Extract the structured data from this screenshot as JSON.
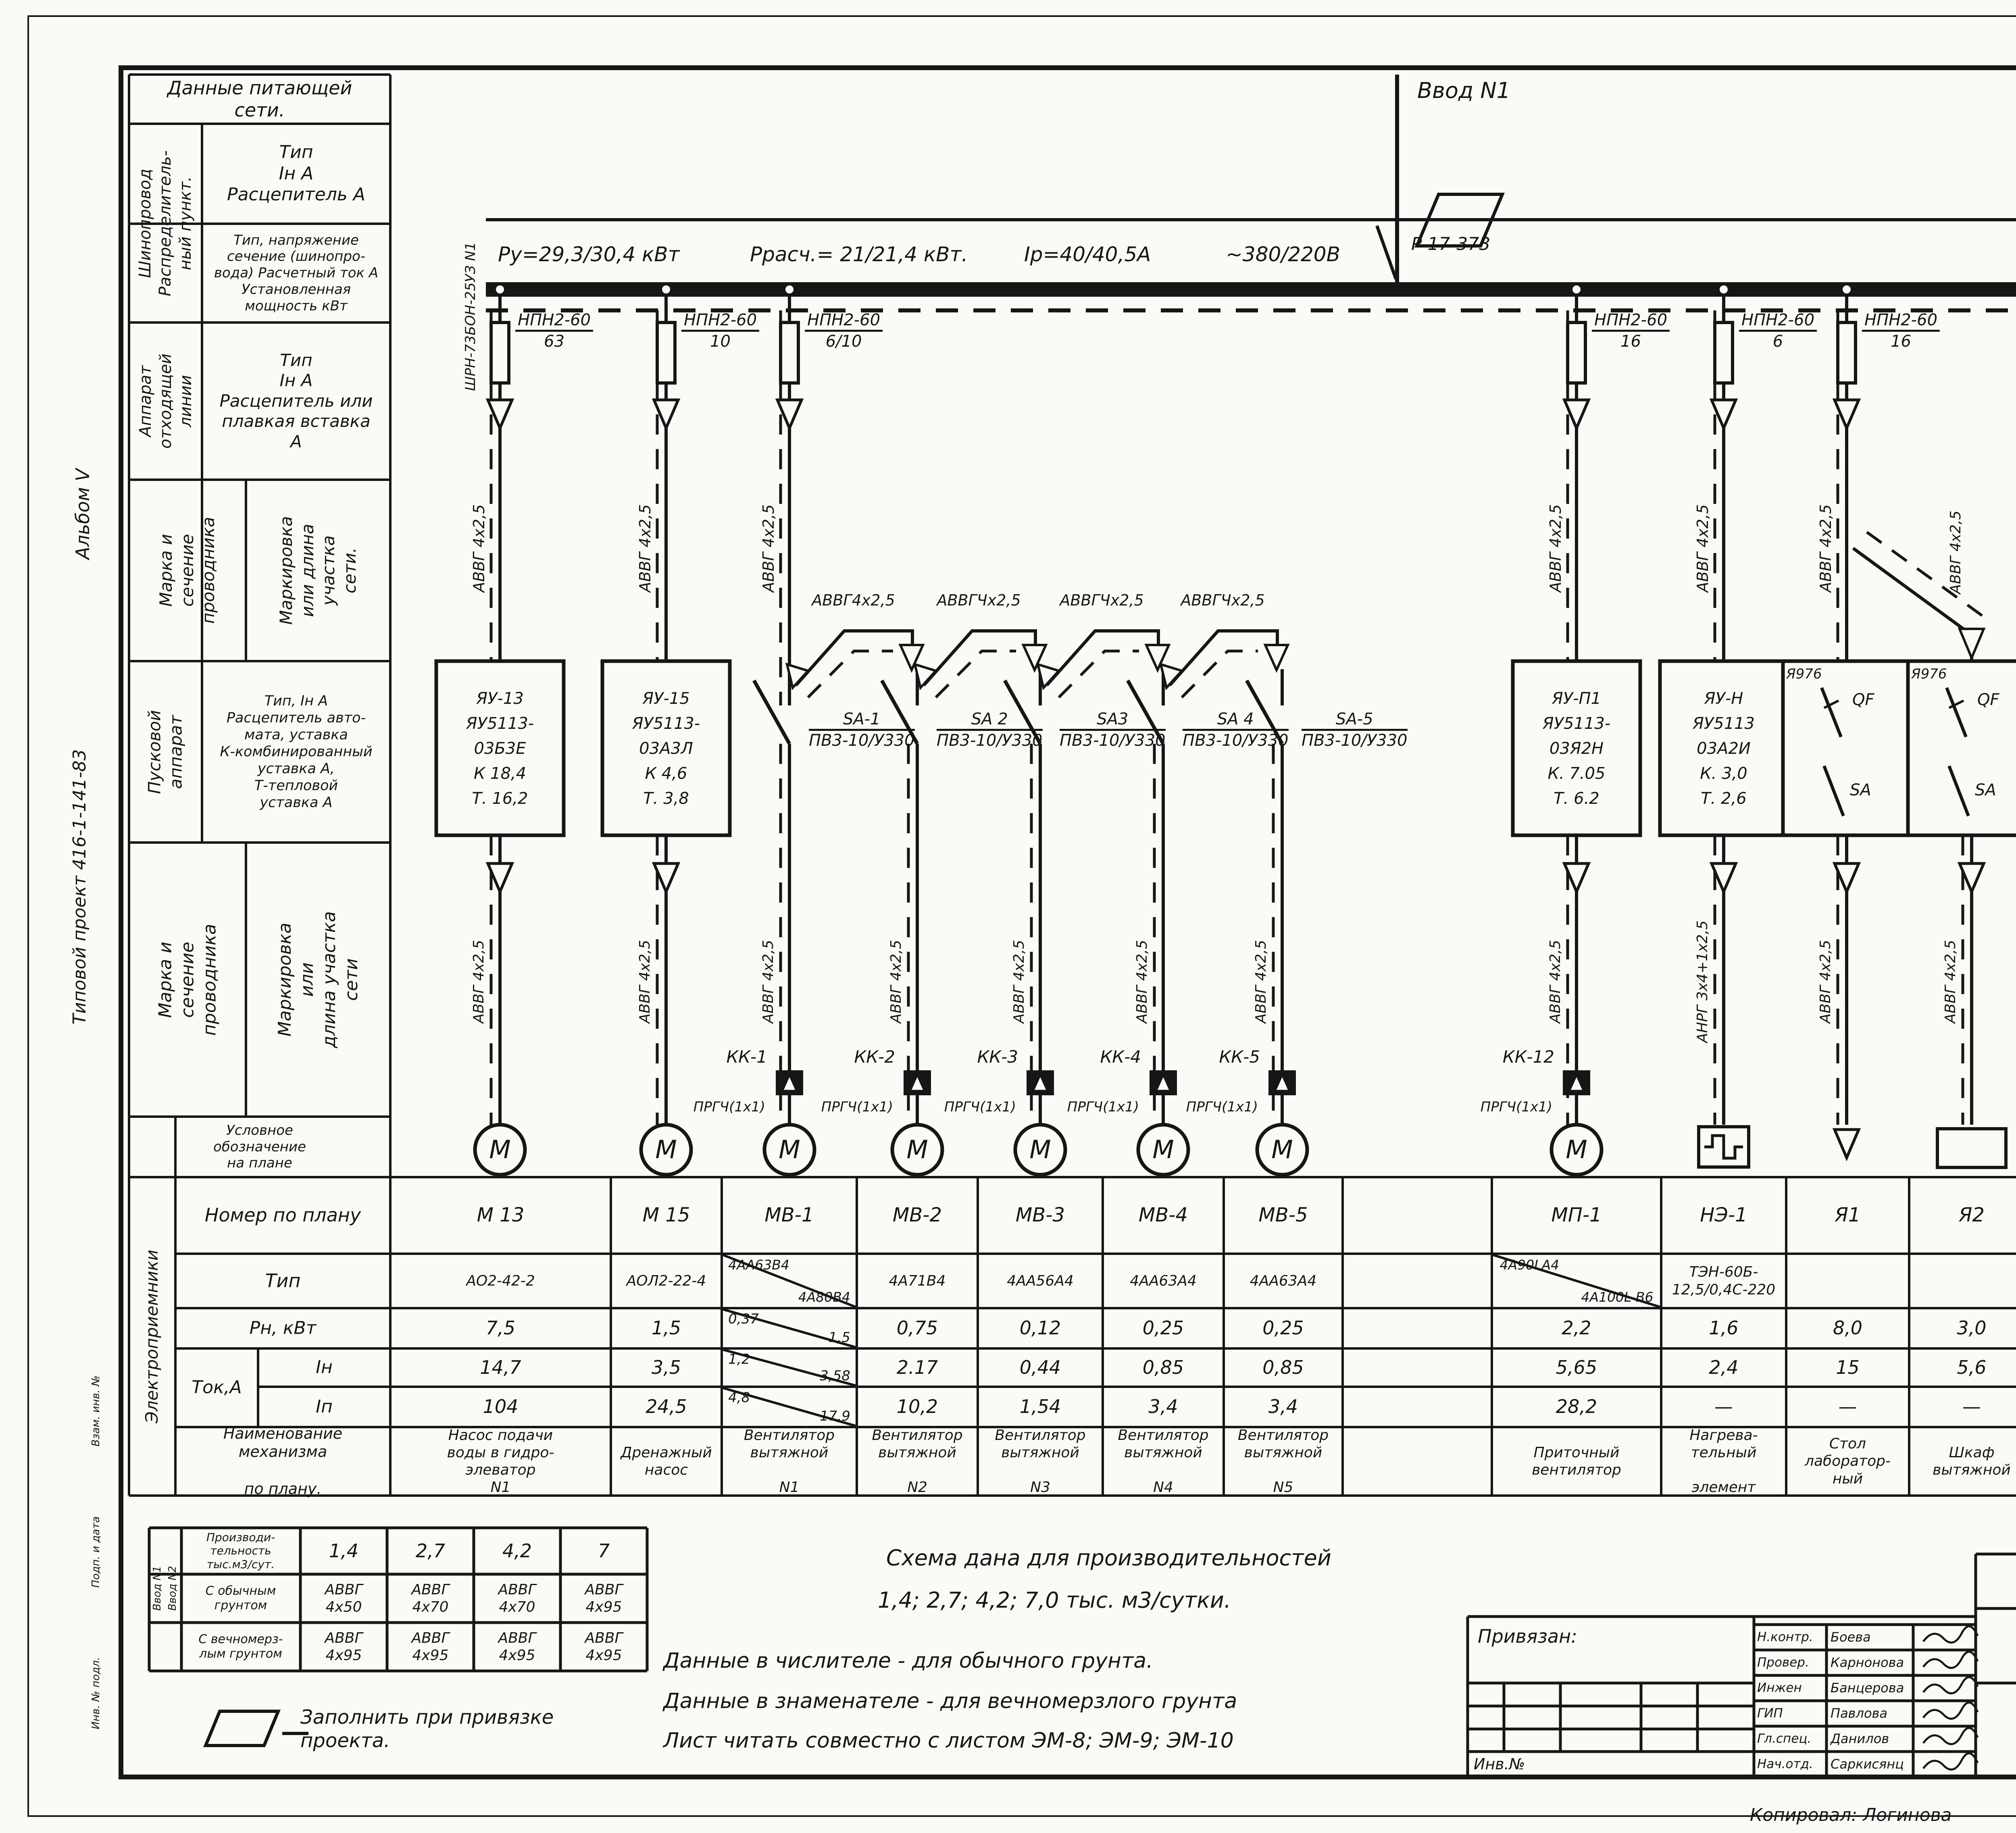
{
  "side": {
    "album": "Альбом V",
    "project": "Типовой проект 416-1-141-83",
    "stamp1": "Взам. инв. №",
    "stamp2": "Подп. и дата",
    "stamp3": "Инв. № подл."
  },
  "powerhead": {
    "title": "Данные питающей\nсети.",
    "busline_group": "Шинопровод\nРаспределитель-\nный пункт.",
    "busline_spec": "Тип\nIн А\nРасцепитель А",
    "busline_spec2": "Тип, напряжение\nсечение (шинопро-\nвода) Расчетный ток А\nУстановленная\nмощность кВт",
    "outgoing_group": "Аппарат\nотходящей\nлинии",
    "outgoing_spec": "Тип\nIн А\nРасцепитель или\nплавкая вставка\nА",
    "wire1_mark": "Марка и\nсечение\nпроводника",
    "wire1_len": "Маркировка\nили длина\nучастка\nсети.",
    "starter_group": "Пусковой\nаппарат",
    "starter_spec": "Тип, Iн А\nРасцепитель авто-\nмата, уставка\nК-комбинированный\nуставка А,\nТ-тепловой\nуставка А",
    "wire2_mark": "Марка и сечение\nпроводника",
    "wire2_len": "Маркировка или\nдлина участка\nсети",
    "symbol_row": "Условное\nобозначение\nна плане"
  },
  "bus": {
    "vvod": "Ввод N1",
    "switch": "Р 17-373",
    "cabinet": "ШРН-73БОН-25УЗ N1",
    "p_inst": "Ру=29,3/30,4 кВт",
    "p_calc": "Ррасч.= 21/21,4 кВт.",
    "i_calc": "Iр=40/40,5А",
    "voltage": "~380/220В"
  },
  "feeders": {
    "m13": {
      "fuse_num": "НПН2-60",
      "fuse_den": "63",
      "cable_top": "АВВГ 4х2,5",
      "box": "ЯУ-13\nЯУ5113-\n03Б3Е\nК 18,4\nТ. 16,2",
      "cable_bot": "АВВГ 4х2,5",
      "sym": "М"
    },
    "m15": {
      "fuse_num": "НПН2-60",
      "fuse_den": "10",
      "cable_top": "АВВГ 4х2,5",
      "box": "ЯУ-15\nЯУ5113-\n03А3Л\nК 4,6\nТ. 3,8",
      "cable_bot": "АВВГ 4х2,5",
      "sym": "М"
    },
    "mv1": {
      "fuse_num": "НПН2-60",
      "fuse_den": "6/10",
      "cable_top": "АВВГ 4х2,5",
      "sa": "SA-1",
      "sa_den": "ПВ3-10/У330",
      "bridge_cable": "АВВГ4х2,5",
      "kk": "КК-1",
      "prg": "ПРГЧ(1х1)",
      "cable_bot": "АВВГ 4х2,5",
      "sym": "М"
    },
    "mv2": {
      "sa": "SA 2",
      "sa_den": "ПВ3-10/У330",
      "bridge_cable": "АВВГЧх2,5",
      "kk": "КК-2",
      "prg": "ПРГЧ(1х1)",
      "cable_bot": "АВВГ 4х2,5",
      "sym": "М"
    },
    "mv3": {
      "sa": "SA3",
      "sa_den": "ПВ3-10/У330",
      "bridge_cable": "АВВГЧх2,5",
      "kk": "КК-3",
      "prg": "ПРГЧ(1х1)",
      "cable_bot": "АВВГ 4х2,5",
      "sym": "М"
    },
    "mv4": {
      "sa": "SA 4",
      "sa_den": "ПВ3-10/У330",
      "bridge_cable": "АВВГЧх2,5",
      "kk": "КК-4",
      "prg": "ПРГЧ(1х1)",
      "cable_bot": "АВВГ 4х2,5",
      "sym": "М"
    },
    "mv5": {
      "sa": "SA-5",
      "sa_den": "ПВ3-10/У330",
      "kk": "КК-5",
      "prg": "ПРГЧ(1х1)",
      "cable_bot": "АВВГ 4х2,5",
      "sym": "М"
    },
    "mp1": {
      "fuse_num": "НПН2-60",
      "fuse_den": "16",
      "cable_top": "АВВГ 4х2,5",
      "box": "ЯУ-П1\nЯУ5113-\n03Я2Н\nК. 7.05\nТ. 6.2",
      "cable_bot": "АВВГ 4х2,5",
      "kk": "КК-12",
      "prg": "ПРГЧ(1х1)",
      "sym": "М"
    },
    "ne1": {
      "fuse_num": "НПН2-60",
      "fuse_den": "6",
      "cable_top": "АВВГ 4х2,5",
      "box": "ЯУ-Н\nЯУ5113\n03А2И\nК. 3,0\nТ. 2,6",
      "cable_bot": "АНРГ 3х4+1х2,5"
    },
    "ya1": {
      "fuse_num": "НПН2-60",
      "fuse_den": "16",
      "cable_top": "АВВГ 4х2,5",
      "qf_tag": "Я976",
      "qf": "QF",
      "sa2": "SA",
      "cable_bot": "АВВГ 4х2,5"
    },
    "ya2": {
      "cable_top": "АВВГ 4х2,5",
      "qf_tag": "Я976",
      "qf": "QF",
      "sa2": "SA",
      "cable_bot": "АВВГ 4х2,5"
    },
    "shr": {
      "fuse_num": "НПН2-60",
      "fuse_den": "10",
      "cable_top": "АВВГ 4х2,5"
    },
    "far": {
      "fuse_num": "НПН2-60",
      "fuse_den": "63",
      "cable_top": "АВВГ 4х16",
      "note": "(для варианта с\nцентрифугой)",
      "dest": "к ШР N3\nлист ЭМ-8"
    }
  },
  "table": {
    "side": "Электроприемники",
    "row_labels": {
      "num": "Номер по плану",
      "type": "Тип",
      "pn": "Рн,    кВт",
      "tok": "Ток,А",
      "iin": "Iн",
      "iip": "Iп",
      "name": "Наименование\nмеханизма\n\nпо плану."
    },
    "columns": [
      {
        "num": "М 13",
        "type": "АО2-42-2",
        "pn": "7,5",
        "iin": "14,7",
        "iip": "104",
        "name": "Насос подачи\nводы в гидро-\nэлеватор\nN1"
      },
      {
        "num": "М 15",
        "type": "АОЛ2-22-4",
        "pn": "1,5",
        "iin": "3,5",
        "iip": "24,5",
        "name": "Дренажный\nнасос"
      },
      {
        "num": "МВ-1",
        "type_n": "4АА63В4",
        "type_d": "4А80В4",
        "pn_n": "0,37",
        "pn_d": "1,5",
        "iin_n": "1,2",
        "iin_d": "3,58",
        "iip_n": "4,8",
        "iip_d": "17,9",
        "name": "Вентилятор\nвытяжной\n\nN1"
      },
      {
        "num": "МВ-2",
        "type": "4А71В4",
        "pn": "0,75",
        "iin": "2.17",
        "iip": "10,2",
        "name": "Вентилятор\nвытяжной\n\nN2"
      },
      {
        "num": "МВ-3",
        "type": "4АА56А4",
        "pn": "0,12",
        "iin": "0,44",
        "iip": "1,54",
        "name": "Вентилятор\nвытяжной\n\nN3"
      },
      {
        "num": "МВ-4",
        "type": "4АА63А4",
        "pn": "0,25",
        "iin": "0,85",
        "iip": "3,4",
        "name": "Вентилятор\nвытяжной\n\nN4"
      },
      {
        "num": "МВ-5",
        "type": "4АА63А4",
        "pn": "0,25",
        "iin": "0,85",
        "iip": "3,4",
        "name": "Вентилятор\nвытяжной\n\nN5"
      },
      {
        "num": "",
        "type": "",
        "pn": "",
        "iin": "",
        "iip": "",
        "name": ""
      },
      {
        "num": "МП-1",
        "type_n": "4А90LА4",
        "type_d": "4А100L В6",
        "pn": "2,2",
        "iin": "5,65",
        "iip": "28,2",
        "name": "Приточный\nвентилятор"
      },
      {
        "num": "НЭ-1",
        "type": "ТЭН-60Б-\n12,5/0,4С-220",
        "pn": "1,6",
        "iin": "2,4",
        "iip": "—",
        "name": "Нагрева-\nтельный\n\nэлемент"
      },
      {
        "num": "Я1",
        "type": "",
        "pn": "8,0",
        "iin": "15",
        "iip": "—",
        "name": "Стол\nлаборатор-\nный"
      },
      {
        "num": "Я2",
        "type": "",
        "pn": "3,0",
        "iin": "5,6",
        "iip": "—",
        "name": "Шкаф\nвытяжной"
      },
      {
        "num": "—",
        "type": "—",
        "pn": "1,25",
        "iin": "1,9",
        "iip": "—",
        "name": "Электроводонагреватели",
        "subs": [
          "ШР1",
          "ШР2",
          "ШР3"
        ]
      }
    ]
  },
  "mini_table": {
    "side1": "Ввод N1",
    "side2": "Ввод N2",
    "header": "Производи-\nтельность\nтыс.м3/сут.",
    "caps": [
      "1,4",
      "2,7",
      "4,2",
      "7"
    ],
    "rows": [
      {
        "label": "С обычным\nгрунтом",
        "vals": [
          "АВВГ\n4х50",
          "АВВГ\n4х70",
          "АВВГ\n4х70",
          "АВВГ\n4х95"
        ]
      },
      {
        "label": "С вечномерз-\nлым грунтом",
        "vals": [
          "АВВГ\n4х95",
          "АВВГ\n4х95",
          "АВВГ\n4х95",
          "АВВГ\n4х95"
        ]
      }
    ]
  },
  "legend": {
    "text": "Заполнить при привязке\nпроекта."
  },
  "notes": {
    "line1": "Схема дана для производительностей",
    "line2": "1,4; 2,7; 4,2; 7,0 тыс. м3/сутки.",
    "line3": "Данные в числителе - для обычного грунта.",
    "line4": "Данные в знаменателе - для вечномерзлого грунта",
    "line5": "Лист читать совместно с листом ЭМ-8; ЭМ-9; ЭМ-10"
  },
  "titleblock": {
    "privyazan": "Привязан:",
    "inv": "Инв.№",
    "sign_rows": [
      {
        "role": "Н.контр.",
        "name": "Боева"
      },
      {
        "role": "Провер.",
        "name": "Карнонова"
      },
      {
        "role": "Инжен",
        "name": "Банцерова"
      },
      {
        "role": "ГИП",
        "name": "Павлова"
      },
      {
        "role": "Гл.спец.",
        "name": "Данилов"
      },
      {
        "role": "Нач.отд.",
        "name": "Саркисянц"
      }
    ],
    "doc_no": "ТП 416-1-141.83",
    "mark": "ЭМ",
    "object": "Административно-производственное\nздание для станции биологической\nочистки сточных вод производи-\nтельностью 1,4; 2,7; 4,2; 7,0 тыс.м3/сутки",
    "stage_h1": "Стадия",
    "stage_h2": "Лист",
    "stage_h3": "Листов",
    "stage_v1": "Р",
    "stage_v2": "7",
    "stage_v3": "",
    "sheet_title": "Схема питания\nЛист 1",
    "org": "ЦНИИЭП\nинженерного оборудования\nг. Москва"
  },
  "footer": {
    "copied": "Копировал: Логинова",
    "doc": "19109-05      10",
    "format": "Формат А1"
  }
}
